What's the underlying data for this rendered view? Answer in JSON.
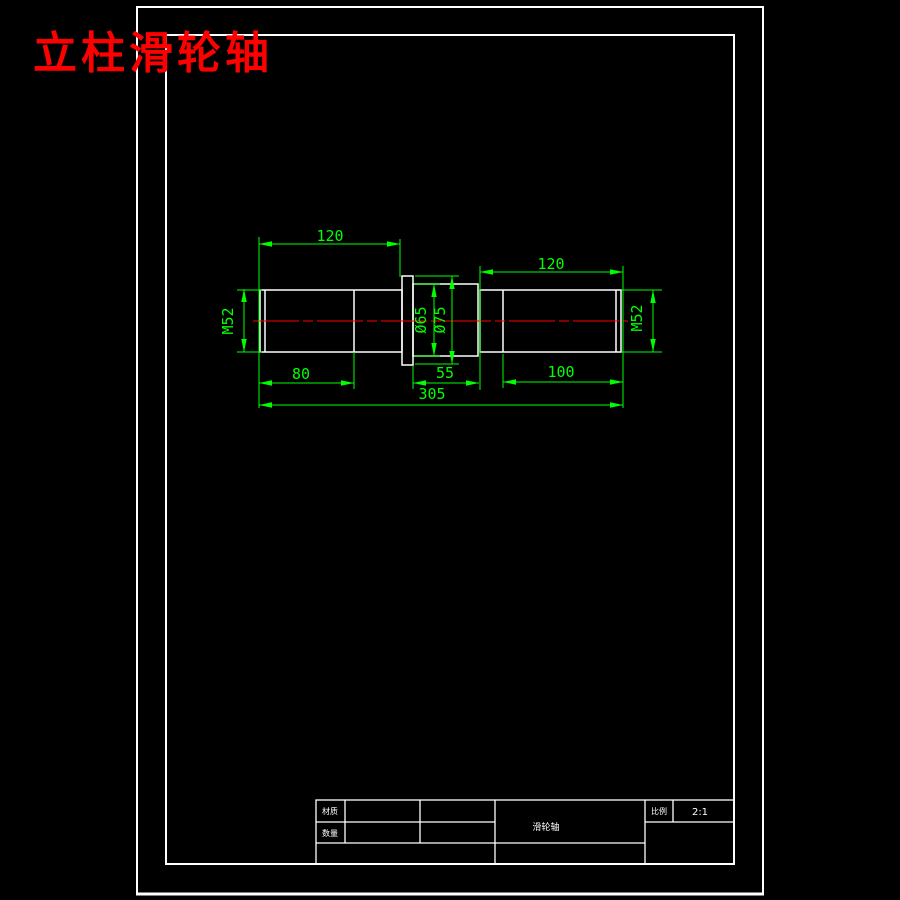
{
  "page": {
    "background": "#000000",
    "title": "立柱滑轮轴",
    "title_color": "#ff0000"
  },
  "drawing": {
    "outline_color": "#ffffff",
    "dimension_color": "#00ff00",
    "centerline_color": "#ff0000",
    "dims": {
      "top_left_length": "120",
      "top_right_length": "120",
      "left_thread": "M52",
      "right_thread": "M52",
      "hub_inner_dia": "Ø65",
      "hub_outer_dia": "Ø75",
      "bottom_left_length": "80",
      "bottom_mid_length": "55",
      "bottom_right_length": "100",
      "total_length": "305"
    }
  },
  "title_block": {
    "material_label": "材质",
    "quantity_label": "数量",
    "part_name": "滑轮轴",
    "scale_label": "比例",
    "scale_value": "2:1"
  }
}
